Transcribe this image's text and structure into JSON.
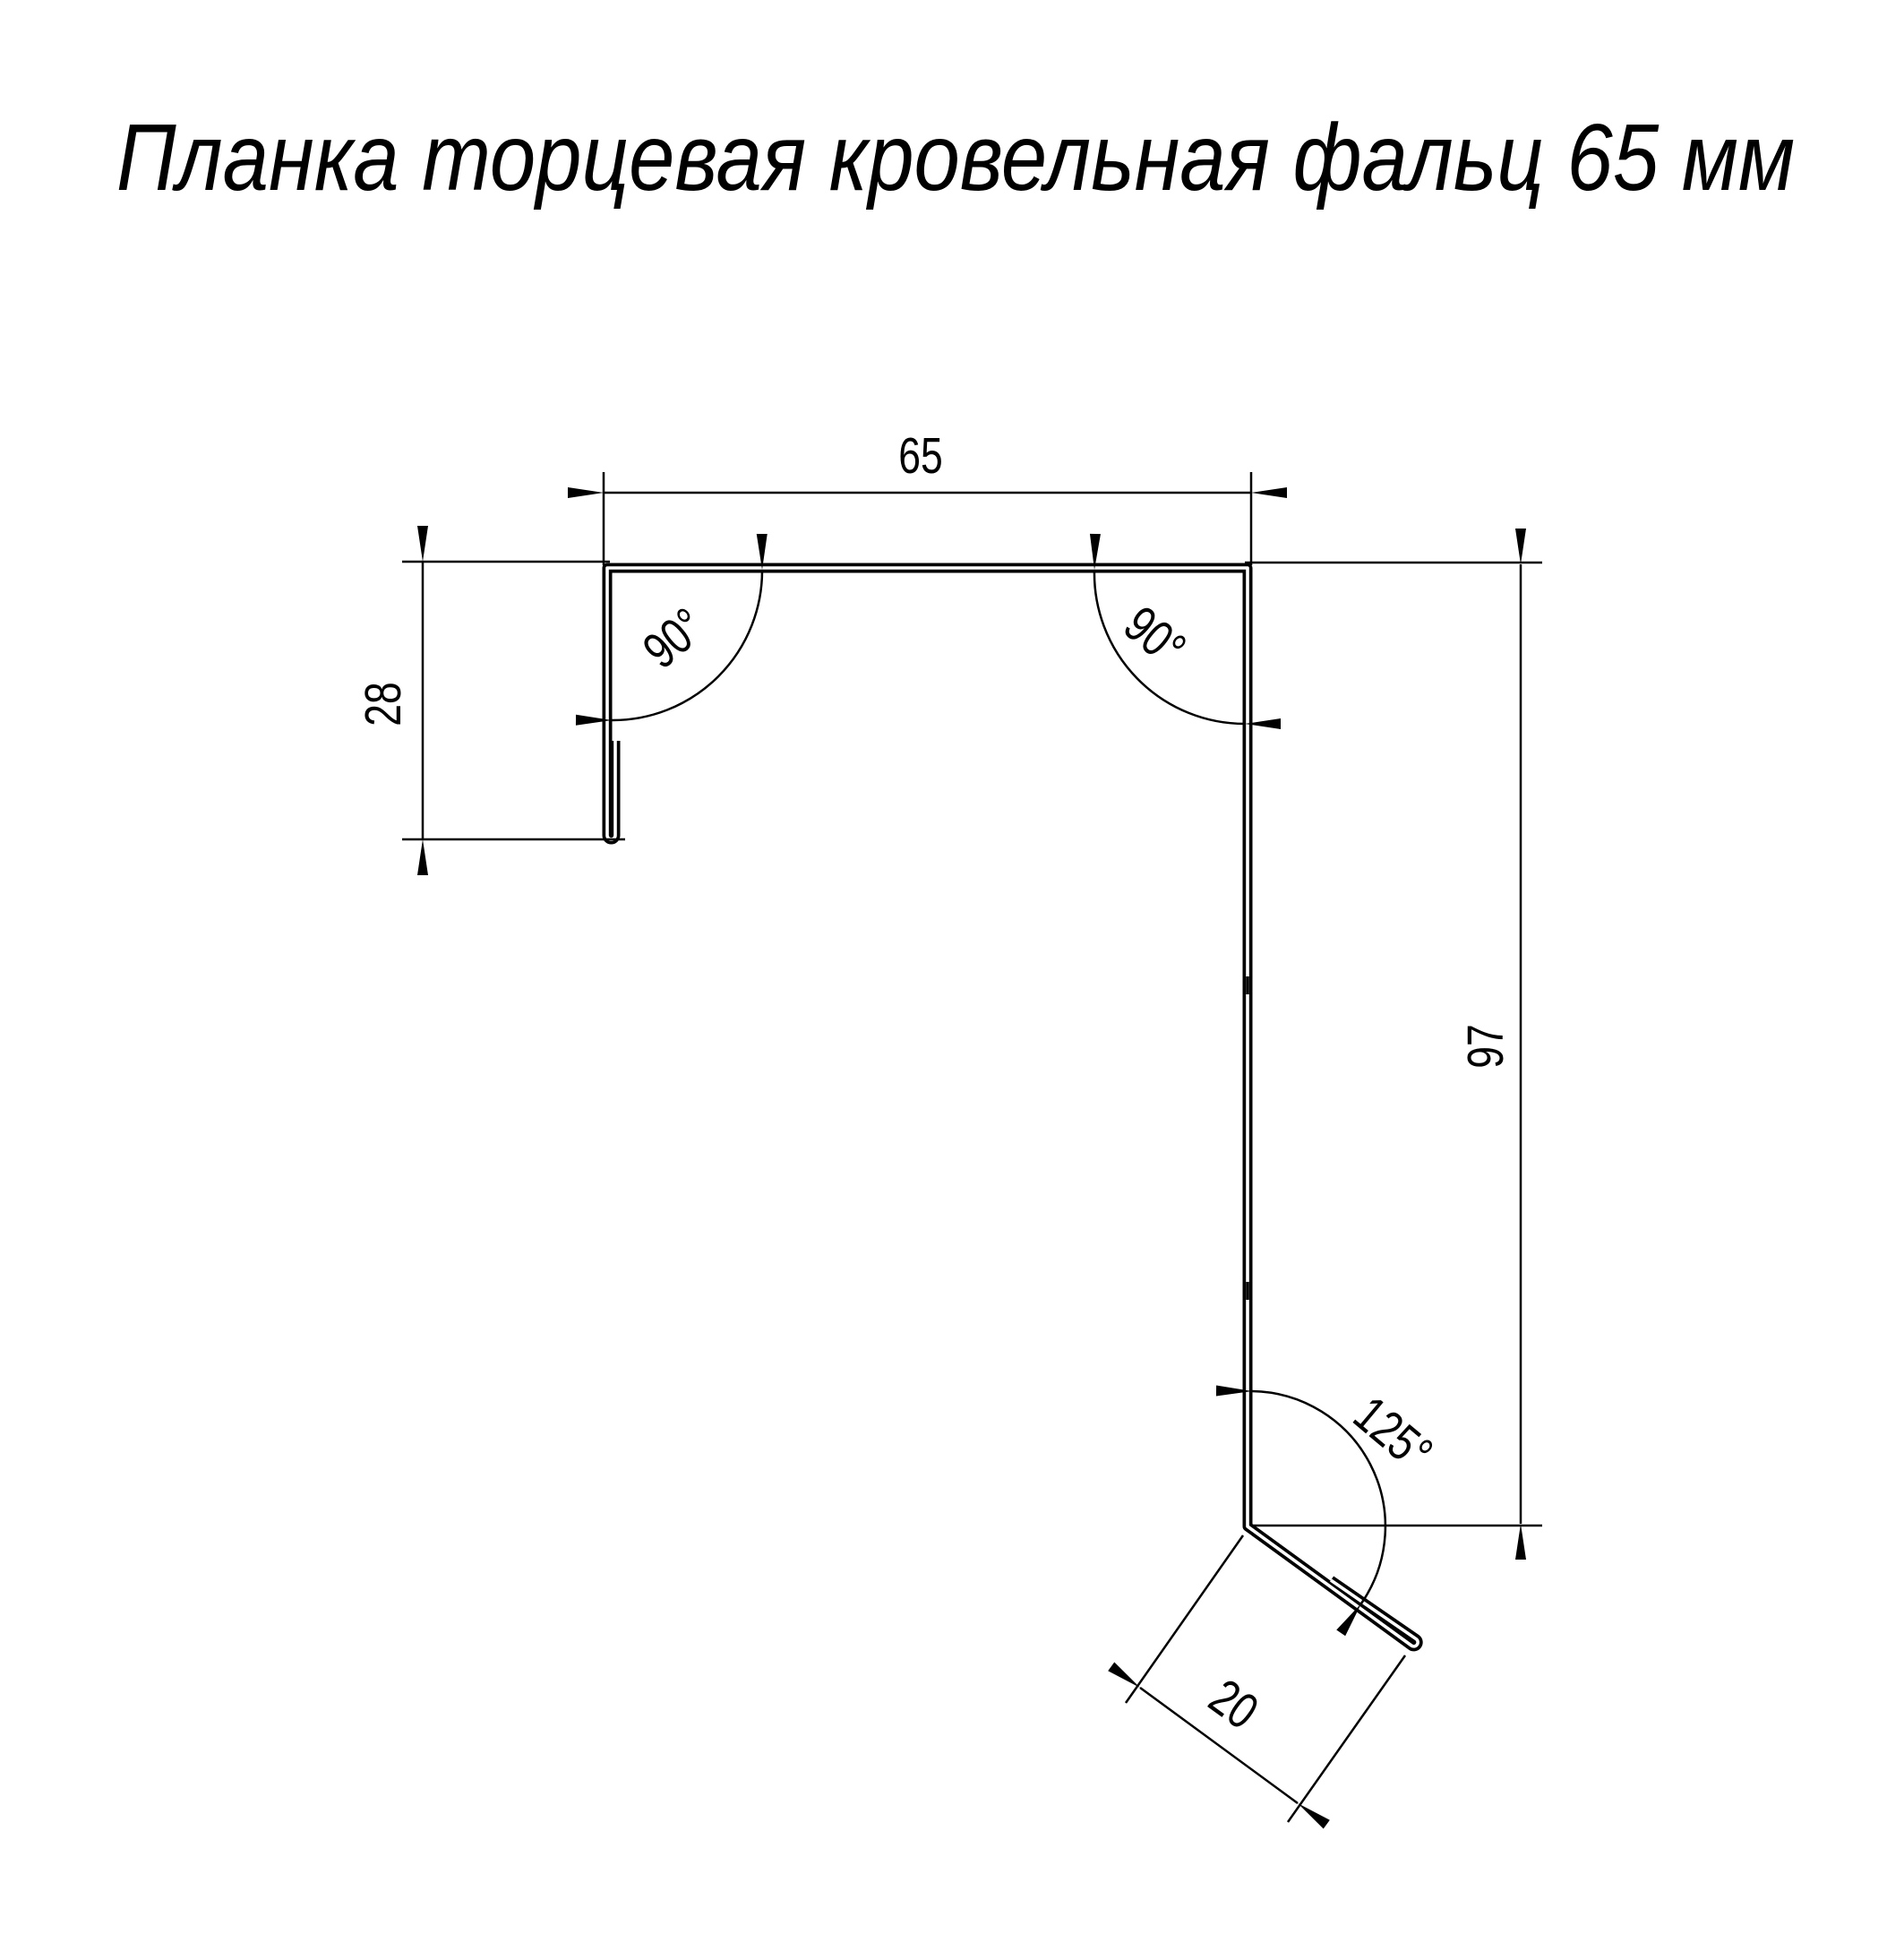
{
  "title": "Планка торцевая кровельная фальц 65 мм",
  "dimensions": {
    "top_width_mm": "65",
    "left_height_mm": "28",
    "right_height_mm": "97",
    "flange_width_mm": "20",
    "angle_top_left": "90°",
    "angle_top_right": "90°",
    "angle_bottom": "125°"
  },
  "style": {
    "line_color": "#000000",
    "background": "#ffffff"
  }
}
